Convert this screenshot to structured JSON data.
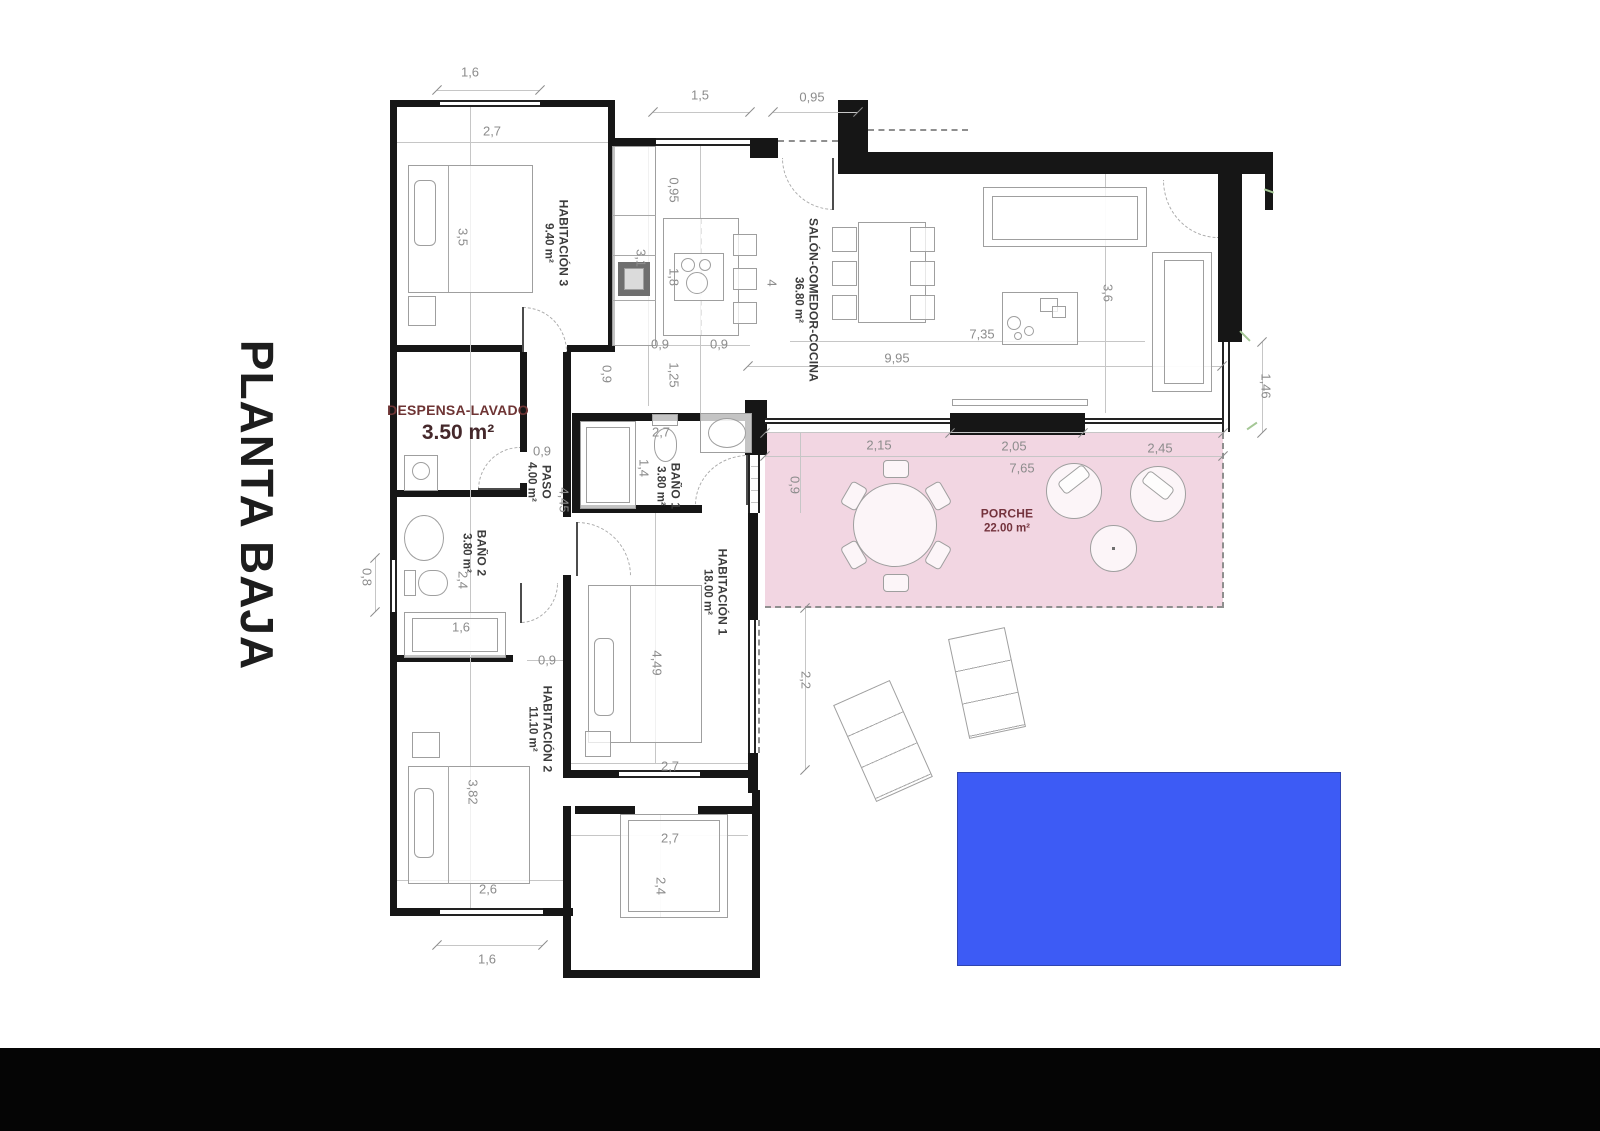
{
  "title": "PLANTA BAJA",
  "colors": {
    "porch_pink": "#f2d6e2",
    "pool_blue": "#3d5bf5",
    "wall_black": "#161616",
    "dim_grey": "#8c8c8c",
    "label_dark": "#3c3c3c",
    "label_maroon": "#74333d"
  },
  "rooms": [
    {
      "id": "habitacion-3",
      "name": "HABITACIÓN 3",
      "area": "9.40 m²",
      "x": 556,
      "y": 243,
      "v": 1,
      "maroon": 0,
      "big": 0
    },
    {
      "id": "salon-comedor-cocina",
      "name": "SALÓN-COMEDOR-COCINA",
      "area": "36.80 m²",
      "x": 806,
      "y": 300,
      "v": 1,
      "maroon": 0,
      "big": 0
    },
    {
      "id": "despensa-lavado",
      "name": "DESPENSA-LAVADO",
      "area": "3.50 m²",
      "x": 458,
      "y": 424,
      "v": 0,
      "maroon": 1,
      "big": 1
    },
    {
      "id": "paso",
      "name": "PASO",
      "area": "4.00 m²",
      "x": 539,
      "y": 482,
      "v": 1,
      "maroon": 0,
      "big": 0
    },
    {
      "id": "bano-1",
      "name": "BAÑO 1",
      "area": "3.80 m²",
      "x": 668,
      "y": 486,
      "v": 1,
      "maroon": 0,
      "big": 0
    },
    {
      "id": "bano-2",
      "name": "BAÑO 2",
      "area": "3.80 m²",
      "x": 474,
      "y": 553,
      "v": 1,
      "maroon": 0,
      "big": 0
    },
    {
      "id": "habitacion-1",
      "name": "HABITACIÓN 1",
      "area": "18.00 m²",
      "x": 715,
      "y": 592,
      "v": 1,
      "maroon": 0,
      "big": 0
    },
    {
      "id": "habitacion-2",
      "name": "HABITACIÓN 2",
      "area": "11.10 m²",
      "x": 540,
      "y": 729,
      "v": 1,
      "maroon": 0,
      "big": 0
    },
    {
      "id": "porche",
      "name": "PORCHE",
      "area": "22.00 m²",
      "x": 1007,
      "y": 521,
      "v": 0,
      "maroon": 1,
      "big": 0
    }
  ],
  "dims": [
    {
      "t": "1,6",
      "x": 470,
      "y": 72,
      "v": 0
    },
    {
      "t": "2,7",
      "x": 492,
      "y": 131,
      "v": 0
    },
    {
      "t": "3,5",
      "x": 463,
      "y": 237,
      "v": 1
    },
    {
      "t": "1,5",
      "x": 700,
      "y": 95,
      "v": 0
    },
    {
      "t": "0,95",
      "x": 812,
      "y": 97,
      "v": 0
    },
    {
      "t": "0,95",
      "x": 674,
      "y": 190,
      "v": 1
    },
    {
      "t": "3,1",
      "x": 641,
      "y": 258,
      "v": 1
    },
    {
      "t": "1,8",
      "x": 674,
      "y": 277,
      "v": 1
    },
    {
      "t": "4",
      "x": 772,
      "y": 283,
      "v": 1
    },
    {
      "t": "0,9",
      "x": 660,
      "y": 344,
      "v": 0
    },
    {
      "t": "0,9",
      "x": 719,
      "y": 344,
      "v": 0
    },
    {
      "t": "0,9",
      "x": 607,
      "y": 374,
      "v": 1
    },
    {
      "t": "1,25",
      "x": 674,
      "y": 375,
      "v": 1
    },
    {
      "t": "9,95",
      "x": 897,
      "y": 358,
      "v": 0
    },
    {
      "t": "7,35",
      "x": 982,
      "y": 334,
      "v": 0
    },
    {
      "t": "3,6",
      "x": 1108,
      "y": 293,
      "v": 1
    },
    {
      "t": "1,46",
      "x": 1266,
      "y": 386,
      "v": 1
    },
    {
      "t": "0,9",
      "x": 542,
      "y": 451,
      "v": 0
    },
    {
      "t": "4,45",
      "x": 564,
      "y": 500,
      "v": 1
    },
    {
      "t": "2,7",
      "x": 661,
      "y": 432,
      "v": 0
    },
    {
      "t": "1,4",
      "x": 644,
      "y": 468,
      "v": 1
    },
    {
      "t": "2,4",
      "x": 463,
      "y": 580,
      "v": 1
    },
    {
      "t": "0,8",
      "x": 367,
      "y": 577,
      "v": 1
    },
    {
      "t": "1,6",
      "x": 461,
      "y": 627,
      "v": 0
    },
    {
      "t": "0,9",
      "x": 547,
      "y": 660,
      "v": 0
    },
    {
      "t": "4,49",
      "x": 657,
      "y": 663,
      "v": 1
    },
    {
      "t": "2,7",
      "x": 670,
      "y": 766,
      "v": 0
    },
    {
      "t": "2,2",
      "x": 806,
      "y": 680,
      "v": 1
    },
    {
      "t": "3,82",
      "x": 473,
      "y": 792,
      "v": 1
    },
    {
      "t": "2,6",
      "x": 488,
      "y": 889,
      "v": 0
    },
    {
      "t": "1,6",
      "x": 487,
      "y": 959,
      "v": 0
    },
    {
      "t": "2,7",
      "x": 670,
      "y": 838,
      "v": 0
    },
    {
      "t": "2,4",
      "x": 661,
      "y": 886,
      "v": 1
    },
    {
      "t": "2,15",
      "x": 879,
      "y": 445,
      "v": 0
    },
    {
      "t": "2,05",
      "x": 1014,
      "y": 446,
      "v": 0
    },
    {
      "t": "2,45",
      "x": 1160,
      "y": 448,
      "v": 0
    },
    {
      "t": "7,65",
      "x": 1022,
      "y": 468,
      "v": 0
    },
    {
      "t": "0,9",
      "x": 795,
      "y": 485,
      "v": 1
    }
  ]
}
